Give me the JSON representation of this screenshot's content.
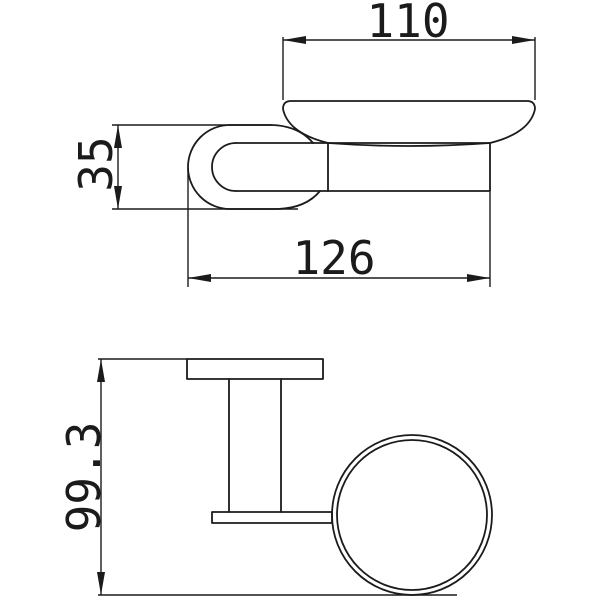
{
  "colors": {
    "line": "#1b1b1b",
    "background": "#ffffff"
  },
  "top_view": {
    "dim_dish_width": "110",
    "dim_mount_width": "35",
    "dim_overall_depth": "126"
  },
  "side_view": {
    "dim_overall_height": "99.3"
  }
}
